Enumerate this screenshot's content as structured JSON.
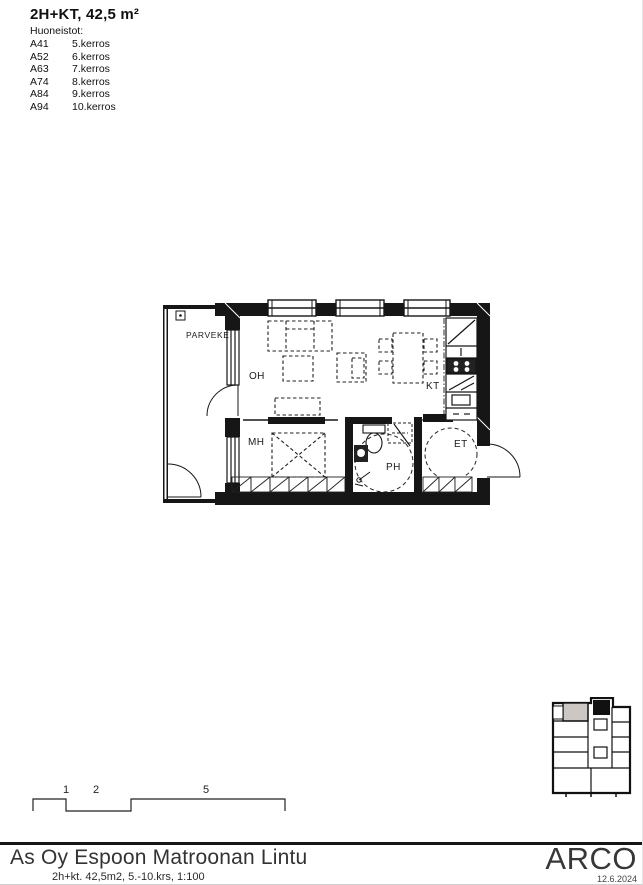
{
  "header": {
    "title": "2H+KT, 42,5 m²",
    "list_heading": "Huoneistot:",
    "units": [
      {
        "code": "A41",
        "floor": "5.kerros"
      },
      {
        "code": "A52",
        "floor": "6.kerros"
      },
      {
        "code": "A63",
        "floor": "7.kerros"
      },
      {
        "code": "A74",
        "floor": "8.kerros"
      },
      {
        "code": "A84",
        "floor": "9.kerros"
      },
      {
        "code": "A94",
        "floor": "10.kerros"
      }
    ]
  },
  "plan": {
    "rooms": {
      "balcony": "PARVEKE",
      "living": "OH",
      "kitchen": "KT",
      "bedroom": "MH",
      "bathroom": "PH",
      "entry": "ET"
    }
  },
  "scalebar": {
    "labels": [
      "1",
      "2",
      "5"
    ]
  },
  "keyplan": {
    "highlight_color": "#cbc8c4"
  },
  "footer": {
    "project": "As Oy Espoon Matroonan Lintu",
    "details": "2h+kt. 42,5m2, 5.-10.krs, 1:100",
    "logo": "ARCO",
    "date": "12.6.2024"
  }
}
